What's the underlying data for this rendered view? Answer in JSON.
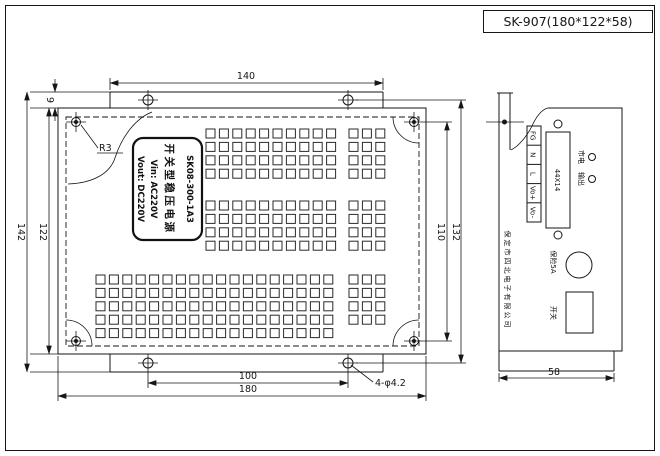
{
  "title_block": {
    "label": "SK-907(180*122*58)"
  },
  "main_view": {
    "label_plate": {
      "model": "SK08-300-1A3",
      "product_name": "开关型稳压电源",
      "input": "Vin:  AC220V",
      "output": "Vout: DC220V"
    },
    "dims": {
      "flange_width": "140",
      "flange_offset": "9",
      "corner_radius": "R3",
      "overall_height": "142",
      "panel_height": "122",
      "mount_hole_span_v": "110",
      "flange_hole_span_v": "132",
      "mount_hole_span_h": "100",
      "panel_width": "180",
      "mount_hole_callout": "4-φ4.2"
    },
    "vent_grids": [
      {
        "x": 206,
        "y": 129,
        "cols": 10,
        "rows": 4,
        "pitch": 13.4,
        "size": 9
      },
      {
        "x": 349,
        "y": 129,
        "cols": 3,
        "rows": 4,
        "pitch": 13.4,
        "size": 9
      },
      {
        "x": 206,
        "y": 201,
        "cols": 10,
        "rows": 4,
        "pitch": 13.4,
        "size": 9
      },
      {
        "x": 349,
        "y": 201,
        "cols": 3,
        "rows": 4,
        "pitch": 13.4,
        "size": 9
      },
      {
        "x": 96,
        "y": 275,
        "cols": 18,
        "rows": 5,
        "pitch": 13.4,
        "size": 9
      },
      {
        "x": 349,
        "y": 275,
        "cols": 3,
        "rows": 4,
        "pitch": 13.4,
        "size": 9
      }
    ]
  },
  "side_view": {
    "terminals": [
      "FG",
      "N",
      "L",
      "Vo+",
      "Vo-"
    ],
    "cutout_size": "44X14",
    "indicator_top": "市电",
    "indicator_bottom": "输出",
    "fuse_label": "保险5A",
    "switch_label": "开关",
    "company": "保定市四北电子有限公司",
    "depth": "58"
  }
}
